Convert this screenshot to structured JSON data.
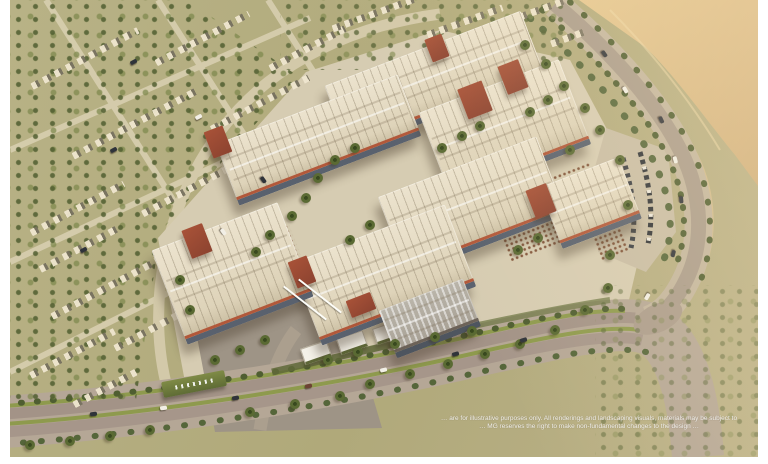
{
  "scene": {
    "kind": "aerial-architectural-rendering",
    "subject": "Bird's-eye 3D render of a commercial office park: cream ridged roofs with terracotta bands and dark glass facades, palm-filled courtyards with outdoor dining terraces, a golden waterfront corniche at top right, low-rise residential rows among dense palms on the left, a landscaped boulevard and gated entrance at the bottom"
  },
  "palette": {
    "frame": "#ffffff",
    "ground_olive": "#b2ab7c",
    "water_gold": "#ddbe8a",
    "road_gray": "#a99b8b",
    "boulevard": "#a39387",
    "paving": "#d6ccb2",
    "roof_cream": "#e6dcc6",
    "terracotta": "#b2583a",
    "brick_tower": "#9c4c36",
    "glass": "#59616e",
    "palm_green": "#5a6a33",
    "grass_median": "#8e9a4d",
    "entrance_sign_green": "#6c783c"
  },
  "entrance_sign": {
    "icon": "white-logo-on-green-hedge-icon"
  },
  "disclaimer": {
    "line1": "… are for illustrative purposes only. All renderings and landscaping visuals, materials may be subject to",
    "line2": "… MG reserves the right to make non-fundamental changes to the design …"
  }
}
